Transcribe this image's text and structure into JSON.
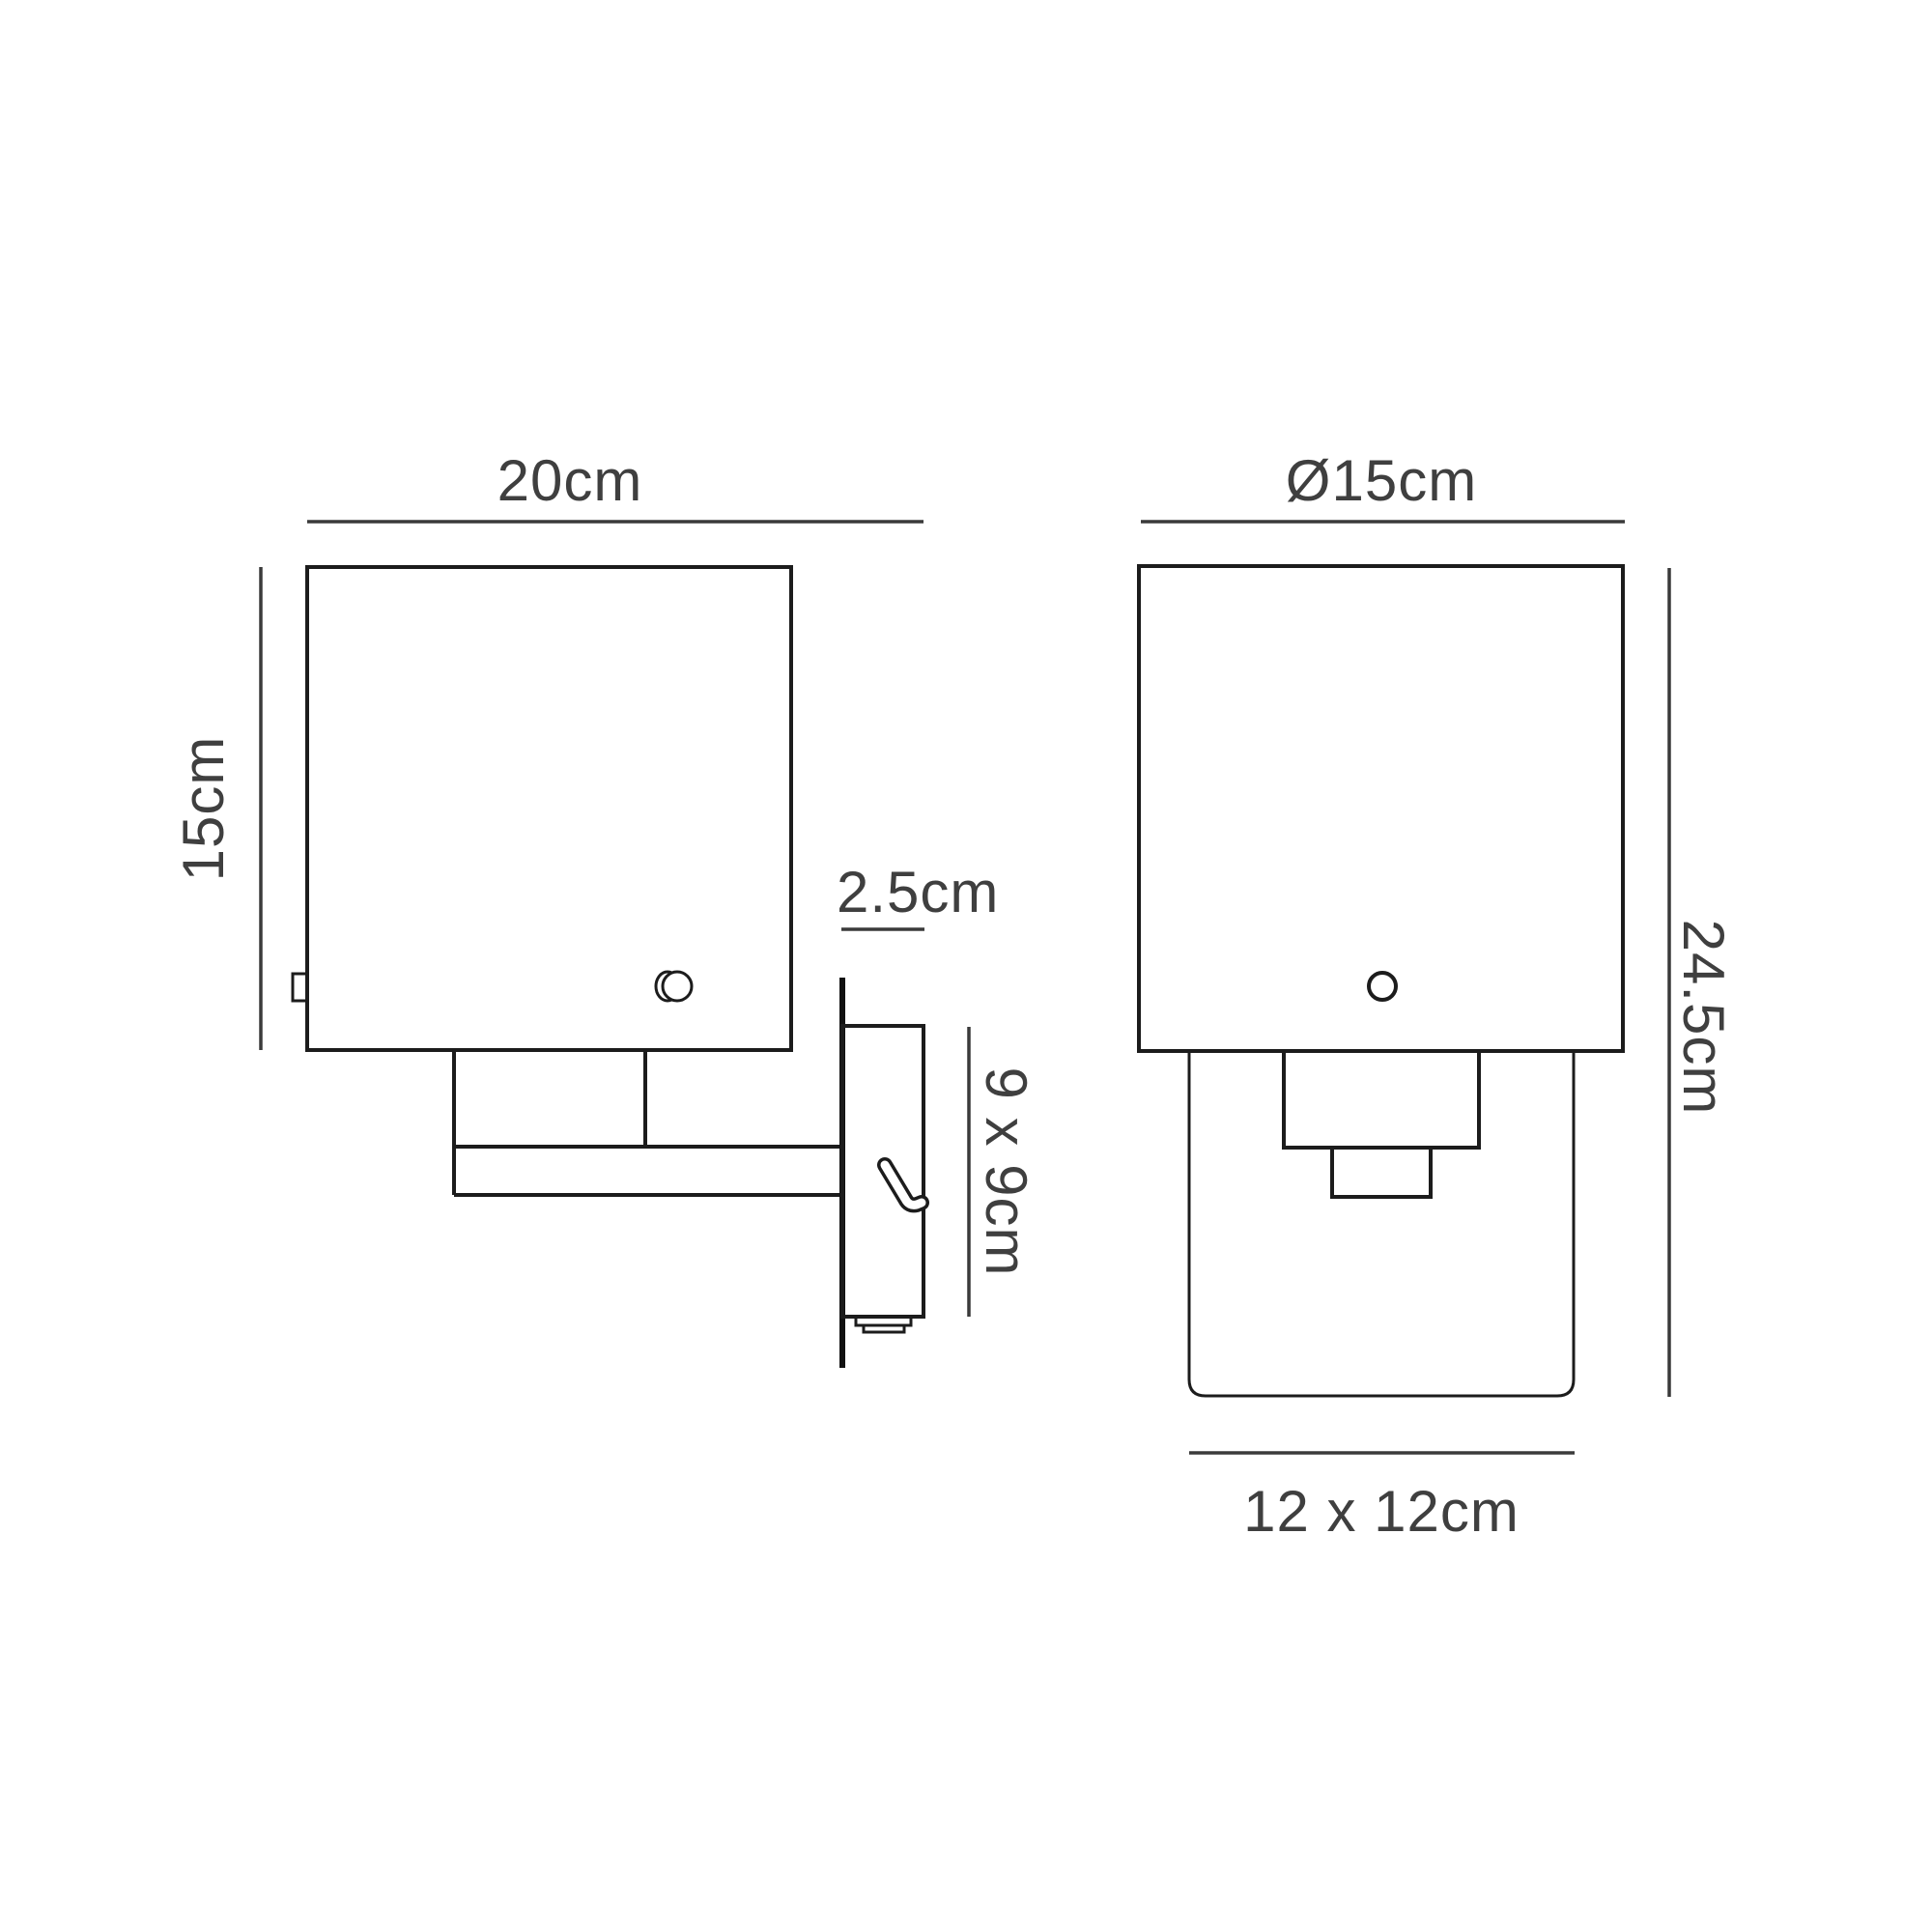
{
  "page": {
    "background": "#ffffff",
    "description": "Technical dimension drawing of a wall light fixture, side view and front view"
  },
  "colors": {
    "outline": "#1c1c1c",
    "dimension_line": "#3a3a3a",
    "label_text": "#3f3f3f"
  },
  "diagram": {
    "type": "technical-drawing",
    "views": [
      {
        "id": "side-view",
        "dimension_labels": [
          "20cm",
          "15cm",
          "2.5cm",
          "9 x 9cm"
        ]
      },
      {
        "id": "front-view",
        "dimension_labels": [
          "Ø15cm",
          "24.5cm",
          "12 x 12cm"
        ]
      }
    ]
  },
  "labels": {
    "side_depth": "20cm",
    "side_shade_height": "15cm",
    "backplate_depth": "2.5cm",
    "backplate_size": "9 x 9cm",
    "front_diameter": "Ø15cm",
    "front_total_height": "24.5cm",
    "front_glass_size": "12 x 12cm"
  }
}
